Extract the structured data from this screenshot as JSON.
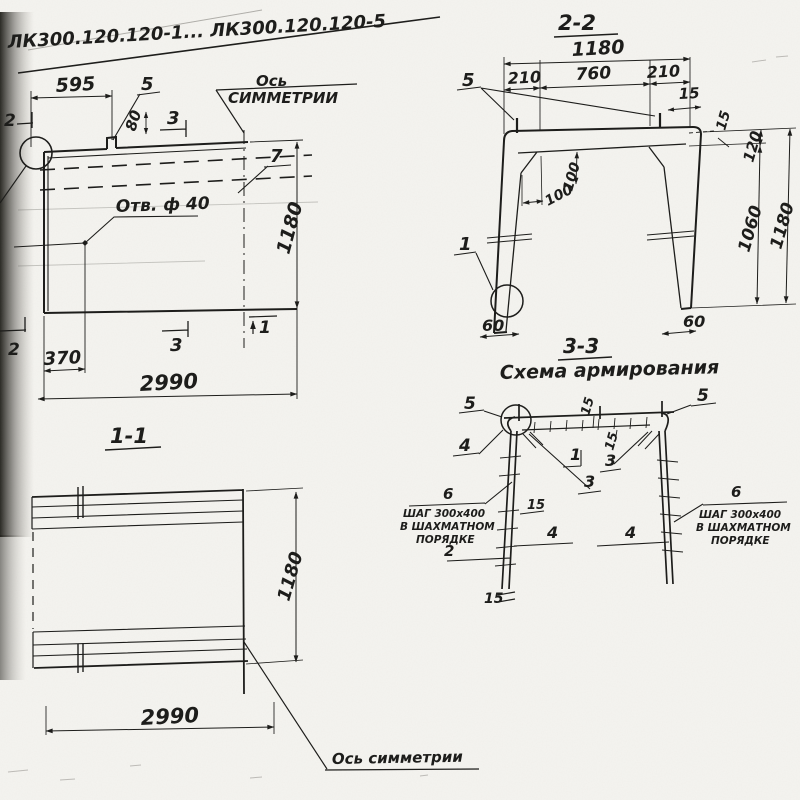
{
  "drawing": {
    "title": "ЛК300.120.120-1... ЛК300.120.120-5",
    "ink_color": "#1d1d1b",
    "paper_color": "#f5f4f0",
    "plan": {
      "d595": "595",
      "l5": "5",
      "d80": "80",
      "m3t": "3",
      "axis1": "Ось",
      "axis2": "СИММЕТРИИ",
      "l7": "7",
      "d1180": "1180",
      "hole": "Отв. ф 40",
      "m2t": "2",
      "m2b": "2",
      "m3b": "3",
      "m1": "1",
      "d370": "370",
      "d2990": "2990"
    },
    "s22": {
      "title": "2-2",
      "d1180t": "1180",
      "d210l": "210",
      "d760": "760",
      "d210r": "210",
      "l5": "5",
      "d15t": "15",
      "d15r": "15",
      "d120": "120",
      "d100v": "100",
      "d100h": "100",
      "d1060": "1060",
      "d1180r": "1180",
      "l1": "1",
      "d60l": "60",
      "d60r": "60"
    },
    "s33": {
      "title": "3-3",
      "subtitle": "Схема армирования",
      "l5l": "5",
      "l5r": "5",
      "l4tl": "4",
      "d15t": "15",
      "d15i": "15",
      "l1": "1",
      "l3a": "3",
      "l3b": "3",
      "l6l": "6",
      "l6r": "6",
      "note1": "ШАГ 300х400",
      "note2": "В ШАХМАТНОМ",
      "note3": "ПОРЯДКЕ",
      "l2": "2",
      "l4ml": "4",
      "l4mr": "4",
      "d15l": "15",
      "d15b": "15"
    },
    "s11": {
      "title": "1-1",
      "d1180": "1180",
      "d2990": "2990",
      "axis": "Ось симметрии"
    }
  }
}
